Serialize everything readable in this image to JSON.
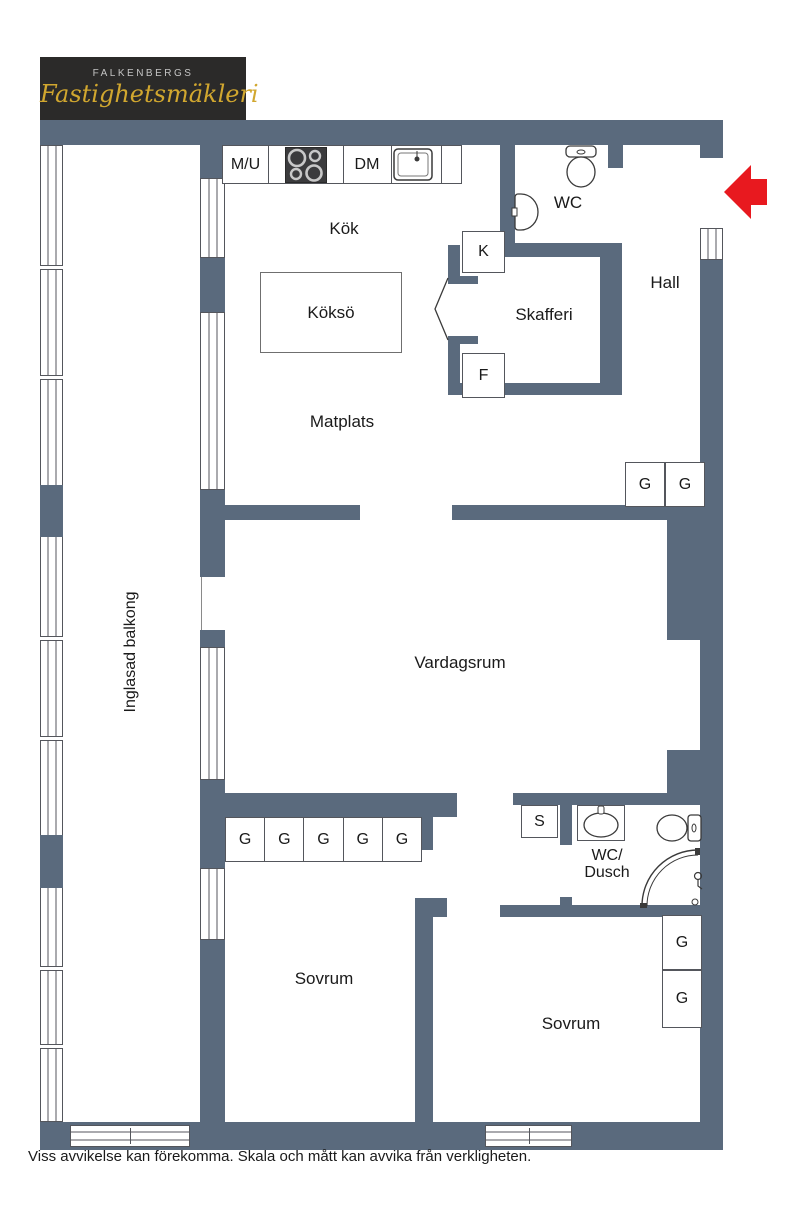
{
  "logo": {
    "brand_top": "FALKENBERGS",
    "brand_script": "Fastighetsmäkleri"
  },
  "rooms": {
    "kok": "Kök",
    "kokso": "Köksö",
    "matplats": "Matplats",
    "skafferi": "Skafferi",
    "wc": "WC",
    "hall": "Hall",
    "vardagsrum": "Vardagsrum",
    "inglasad_balkong": "Inglasad balkong",
    "sovrum_left": "Sovrum",
    "sovrum_right": "Sovrum",
    "wc_dusch_line1": "WC/",
    "wc_dusch_line2": "Dusch"
  },
  "fixtures": {
    "mu": "M/U",
    "dm": "DM",
    "kyl": "K",
    "frys": "F",
    "stad": "S",
    "garderob": "G"
  },
  "footer": {
    "disclaimer": "Viss avvikelse kan förekomma. Skala och mått kan avvika från verkligheten."
  },
  "colors": {
    "wall": "#5a6a7d",
    "arrow": "#e8191f",
    "logo_bg": "#2b2a29",
    "logo_gold": "#d1a72f"
  }
}
